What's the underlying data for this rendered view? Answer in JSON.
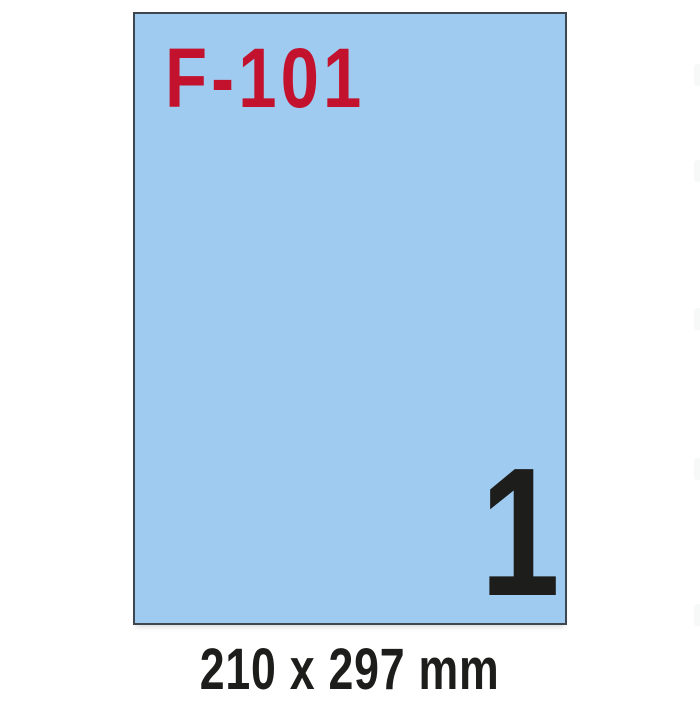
{
  "sheet": {
    "product_code": "F-101",
    "labels_per_sheet": "1",
    "format_label": "210 x 297 mm"
  },
  "colors": {
    "background": "#FFFFFF",
    "sheet_fill": "#9ECBEF",
    "sheet_border": "#3E4750",
    "product_code_red": "#C3122E",
    "text_black": "#1D1D1B",
    "artifact_gray": "#F7F8F8"
  }
}
